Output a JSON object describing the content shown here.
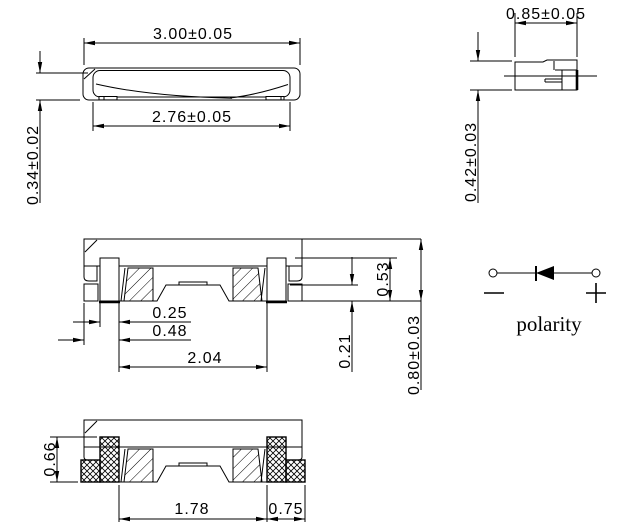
{
  "views": {
    "top": {
      "width": "3.00±0.05",
      "inner_width": "2.76±0.05",
      "edge_height": "0.34±0.02"
    },
    "side": {
      "width": "0.85±0.05",
      "height": "0.42±0.03"
    },
    "front_section": {
      "pad_inset": "0.25",
      "pad_to_edge": "0.48",
      "pad_span": "2.04",
      "cavity_depth": "0.53",
      "standoff": "0.21",
      "body_height": "0.80±0.03"
    },
    "bottom_section": {
      "terminal_height": "0.66",
      "pad_span": "1.78",
      "pad_width": "0.75"
    },
    "polarity": {
      "caption": "polarity"
    }
  },
  "colors": {
    "line": "#000000",
    "background": "#ffffff"
  }
}
